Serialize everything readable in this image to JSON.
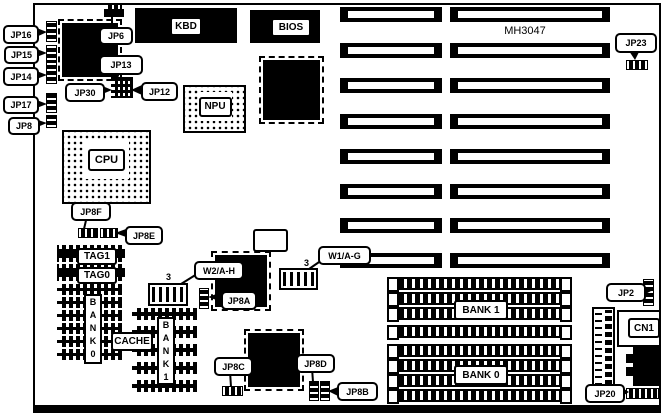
{
  "diagram": {
    "title": "MH3047",
    "callouts": {
      "jp16": "JP16",
      "jp15": "JP15",
      "jp14": "JP14",
      "jp17": "JP17",
      "jp8": "JP8",
      "jp6": "JP6",
      "jp13": "JP13",
      "jp30": "JP30",
      "jp12": "JP12",
      "jp23": "JP23",
      "jp8f": "JP8F",
      "jp8e": "JP8E",
      "jp8a": "JP8A",
      "jp8c": "JP8C",
      "jp8d": "JP8D",
      "jp8b": "JP8B",
      "jp2": "JP2",
      "jp20": "JP20",
      "w2": "W2/A-H",
      "w1": "W1/A-G",
      "w2_pin": "3",
      "w1_pin": "3"
    },
    "chips": {
      "kbd": "KBD",
      "bios": "BIOS",
      "cpu": "CPU",
      "npu": "NPU",
      "tag1": "TAG1",
      "tag0": "TAG0",
      "cache": "CACHE",
      "bank0_column": "B A N K 0",
      "bank1_column": "B A N K 1"
    },
    "memory": {
      "bank1": "BANK 1",
      "bank0": "BANK 0"
    },
    "connectors": {
      "cn1": "CN1"
    },
    "colors": {
      "ink": "#000000",
      "paper": "#ffffff"
    }
  }
}
